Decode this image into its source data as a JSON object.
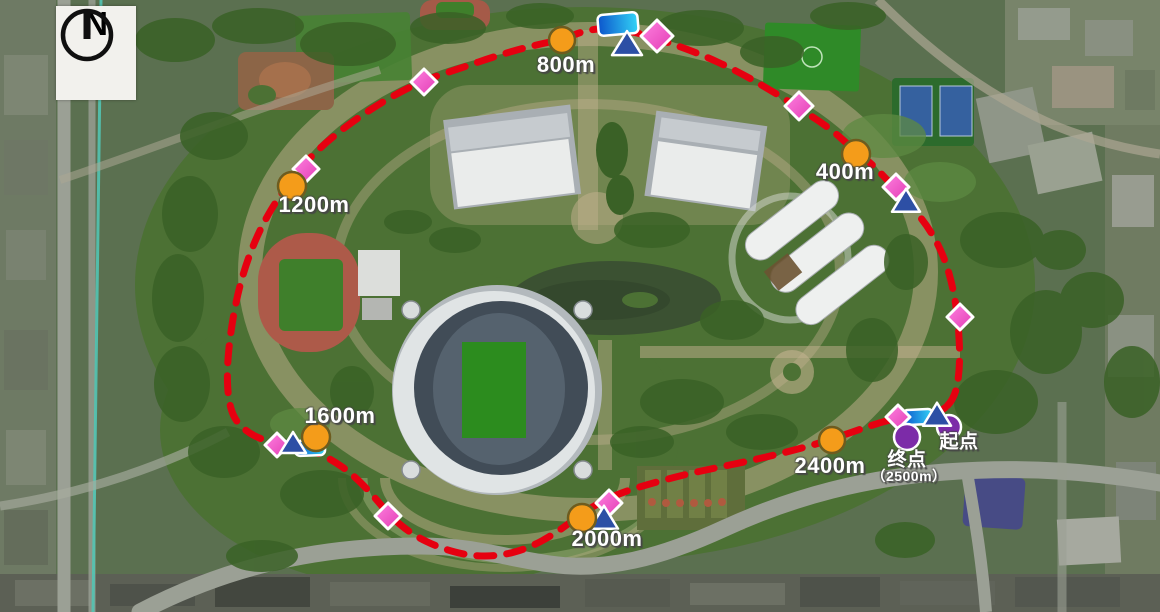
{
  "compass": {
    "label": "N"
  },
  "colors": {
    "route": "#e60010",
    "distance_point": "#f49c1a",
    "distance_point_border": "#6e5c1f",
    "waypoint_diamond": "#f055c8",
    "triangle": "#2d4fa5",
    "flag_blue": "#0c55cc",
    "flag_cyan": "#33d4f6",
    "endpoint": "#7c2ba8",
    "label_text": "#ffffff"
  },
  "route": {
    "total_distance_label": "（2500m）",
    "start_label": "起点",
    "finish_label": "终点",
    "points": [
      [
        940,
        413
      ],
      [
        955,
        398
      ],
      [
        960,
        368
      ],
      [
        959,
        330
      ],
      [
        954,
        291
      ],
      [
        944,
        256
      ],
      [
        929,
        228
      ],
      [
        911,
        206
      ],
      [
        893,
        186
      ],
      [
        871,
        163
      ],
      [
        854,
        150
      ],
      [
        831,
        129
      ],
      [
        799,
        108
      ],
      [
        767,
        88
      ],
      [
        735,
        70
      ],
      [
        700,
        54
      ],
      [
        667,
        42
      ],
      [
        639,
        33
      ],
      [
        611,
        28
      ],
      [
        586,
        30
      ],
      [
        564,
        39
      ],
      [
        531,
        46
      ],
      [
        496,
        56
      ],
      [
        461,
        68
      ],
      [
        422,
        81
      ],
      [
        387,
        99
      ],
      [
        353,
        121
      ],
      [
        324,
        144
      ],
      [
        302,
        166
      ],
      [
        280,
        195
      ],
      [
        262,
        225
      ],
      [
        248,
        258
      ],
      [
        238,
        292
      ],
      [
        231,
        329
      ],
      [
        227,
        367
      ],
      [
        228,
        398
      ],
      [
        234,
        419
      ],
      [
        247,
        432
      ],
      [
        263,
        440
      ],
      [
        282,
        445
      ],
      [
        301,
        448
      ],
      [
        316,
        452
      ],
      [
        334,
        461
      ],
      [
        352,
        474
      ],
      [
        371,
        493
      ],
      [
        391,
        517
      ],
      [
        413,
        535
      ],
      [
        440,
        548
      ],
      [
        470,
        556
      ],
      [
        500,
        556
      ],
      [
        529,
        548
      ],
      [
        556,
        533
      ],
      [
        580,
        515
      ],
      [
        602,
        501
      ],
      [
        626,
        491
      ],
      [
        653,
        483
      ],
      [
        683,
        475
      ],
      [
        715,
        468
      ],
      [
        749,
        461
      ],
      [
        783,
        453
      ],
      [
        813,
        445
      ],
      [
        835,
        438
      ],
      [
        861,
        429
      ],
      [
        885,
        421
      ],
      [
        906,
        417
      ],
      [
        925,
        414
      ]
    ]
  },
  "labels": [
    {
      "id": "label-800m",
      "text": "800m",
      "x": 566,
      "y": 65,
      "size": 22
    },
    {
      "id": "label-400m",
      "text": "400m",
      "x": 845,
      "y": 172,
      "size": 22
    },
    {
      "id": "label-1200m",
      "text": "1200m",
      "x": 314,
      "y": 205,
      "size": 22
    },
    {
      "id": "label-1600m",
      "text": "1600m",
      "x": 340,
      "y": 416,
      "size": 22
    },
    {
      "id": "label-2000m",
      "text": "2000m",
      "x": 607,
      "y": 539,
      "size": 22
    },
    {
      "id": "label-2400m",
      "text": "2400m",
      "x": 830,
      "y": 466,
      "size": 22
    },
    {
      "id": "label-finish",
      "text": "终点",
      "x": 907,
      "y": 458,
      "size": 19
    },
    {
      "id": "label-finish-distance",
      "text": "（2500m）",
      "x": 909,
      "y": 476,
      "size": 14
    },
    {
      "id": "label-start",
      "text": "起点",
      "x": 959,
      "y": 440,
      "size": 19
    }
  ],
  "markers": [
    {
      "name": "flag-icon-800m",
      "type": "flag",
      "x": 618,
      "y": 24,
      "w": 40,
      "h": 21,
      "rot": -5
    },
    {
      "name": "flag-icon-1600m",
      "type": "flag",
      "x": 310,
      "y": 448,
      "w": 30,
      "h": 15,
      "rot": -2
    },
    {
      "name": "flag-icon-start",
      "type": "flag",
      "x": 918,
      "y": 417,
      "w": 30,
      "h": 15,
      "rot": -3
    },
    {
      "name": "start-point-icon",
      "type": "circle-purple",
      "x": 949,
      "y": 427,
      "r": 12
    },
    {
      "name": "waypoint-diamond-icon",
      "type": "diamond",
      "x": 657,
      "y": 36,
      "r": 16
    },
    {
      "name": "waypoint-diamond-icon",
      "type": "diamond",
      "x": 424,
      "y": 82,
      "r": 13
    },
    {
      "name": "waypoint-diamond-icon",
      "type": "diamond",
      "x": 306,
      "y": 169,
      "r": 13
    },
    {
      "name": "waypoint-diamond-icon",
      "type": "diamond",
      "x": 277,
      "y": 445,
      "r": 12
    },
    {
      "name": "waypoint-diamond-icon",
      "type": "diamond",
      "x": 388,
      "y": 516,
      "r": 13
    },
    {
      "name": "waypoint-diamond-icon",
      "type": "diamond",
      "x": 609,
      "y": 503,
      "r": 13
    },
    {
      "name": "waypoint-diamond-icon",
      "type": "diamond",
      "x": 898,
      "y": 417,
      "r": 12
    },
    {
      "name": "waypoint-diamond-icon",
      "type": "diamond",
      "x": 960,
      "y": 317,
      "r": 13
    },
    {
      "name": "waypoint-diamond-icon",
      "type": "diamond",
      "x": 896,
      "y": 187,
      "r": 13
    },
    {
      "name": "waypoint-diamond-icon",
      "type": "diamond",
      "x": 799,
      "y": 106,
      "r": 14
    },
    {
      "name": "waypoint-triangle-icon",
      "type": "triangle",
      "x": 627,
      "y": 46,
      "b": 30,
      "h": 24
    },
    {
      "name": "waypoint-triangle-icon",
      "type": "triangle",
      "x": 906,
      "y": 203,
      "b": 28,
      "h": 23
    },
    {
      "name": "waypoint-triangle-icon",
      "type": "triangle",
      "x": 293,
      "y": 445,
      "b": 26,
      "h": 21
    },
    {
      "name": "waypoint-triangle-icon",
      "type": "triangle",
      "x": 604,
      "y": 520,
      "b": 28,
      "h": 23
    },
    {
      "name": "waypoint-triangle-icon",
      "type": "triangle",
      "x": 937,
      "y": 417,
      "b": 28,
      "h": 23
    },
    {
      "name": "finish-point-icon",
      "type": "circle-purple",
      "x": 907,
      "y": 437,
      "r": 13
    },
    {
      "name": "distance-point-800m",
      "type": "circle-orange",
      "x": 562,
      "y": 40,
      "r": 13
    },
    {
      "name": "distance-point-400m",
      "type": "circle-orange",
      "x": 856,
      "y": 154,
      "r": 14
    },
    {
      "name": "distance-point-1200m",
      "type": "circle-orange",
      "x": 292,
      "y": 186,
      "r": 14
    },
    {
      "name": "distance-point-1600m",
      "type": "circle-orange",
      "x": 316,
      "y": 437,
      "r": 14
    },
    {
      "name": "distance-point-2000m",
      "type": "circle-orange",
      "x": 582,
      "y": 518,
      "r": 14
    },
    {
      "name": "distance-point-2400m",
      "type": "circle-orange",
      "x": 832,
      "y": 440,
      "r": 13
    }
  ]
}
